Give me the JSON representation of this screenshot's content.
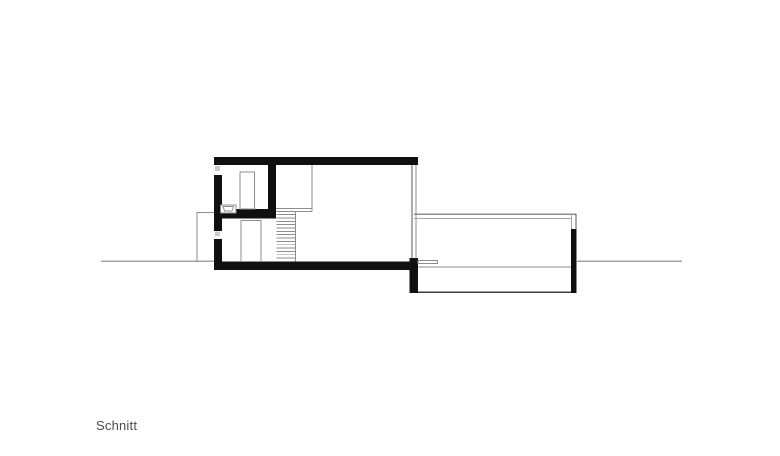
{
  "drawing": {
    "caption": "Schnitt",
    "type": "architectural-section",
    "stair_tread_count": 14,
    "colors": {
      "ink": "#101010",
      "line_dark": "#5a5a5a",
      "line_mid": "#8c8c8c",
      "line_light": "#a6a6a6",
      "ground_line": "#a3a3a3",
      "glazing": "#c9c9c9",
      "caption_text": "#4c4c4c",
      "background": "#ffffff"
    }
  }
}
